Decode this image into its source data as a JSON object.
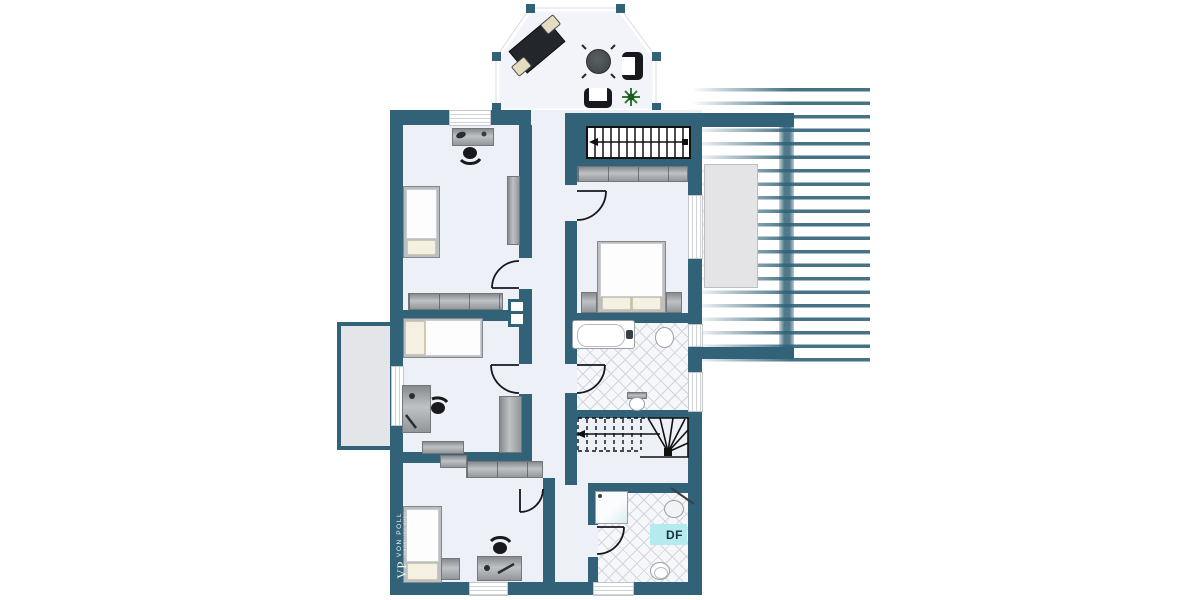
{
  "labels": {
    "roof_window": "DF"
  },
  "watermark": {
    "monogram": "VP",
    "name": "VON POLL",
    "subtitle": "IMMOBILIEN GMBH"
  },
  "colors": {
    "wall": "#316277",
    "floor": "#edf0f6",
    "bay_floor": "#f2f4fa",
    "balcony": "#e4e5e9",
    "tile_line": "#d2d5dc",
    "tile_floor": "#f6f7fa",
    "highlight_cyan": "#b5ebef",
    "furn_gray": "#a9acae",
    "dark_furn": "#1e2126",
    "plant_green": "#2f7a33"
  },
  "rooms": [
    {
      "name": "bay-window-study",
      "furniture": [
        "desk",
        "chair",
        "chair",
        "round-table",
        "armchair",
        "armchair",
        "plant"
      ]
    },
    {
      "name": "bedroom-top-left",
      "furniture": [
        "desk",
        "office-chair",
        "single-bed",
        "wardrobe",
        "sideboard"
      ]
    },
    {
      "name": "bedroom-middle-left",
      "furniture": [
        "single-bed",
        "desk",
        "office-chair",
        "shelf",
        "sideboard"
      ]
    },
    {
      "name": "bedroom-bottom-left",
      "furniture": [
        "single-bed",
        "nightstand",
        "desk",
        "office-chair",
        "wardrobe",
        "wardrobe"
      ]
    },
    {
      "name": "bedroom-master",
      "furniture": [
        "double-bed",
        "nightstand",
        "nightstand",
        "wardrobe"
      ]
    },
    {
      "name": "bathroom-upper",
      "furniture": [
        "bathtub",
        "sink",
        "toilet"
      ]
    },
    {
      "name": "bathroom-lower",
      "furniture": [
        "shower",
        "sink",
        "toilet"
      ],
      "label": "DF"
    },
    {
      "name": "staircase-upper"
    },
    {
      "name": "staircase-lower"
    },
    {
      "name": "balcony-left"
    },
    {
      "name": "roof-terrace-right"
    }
  ]
}
